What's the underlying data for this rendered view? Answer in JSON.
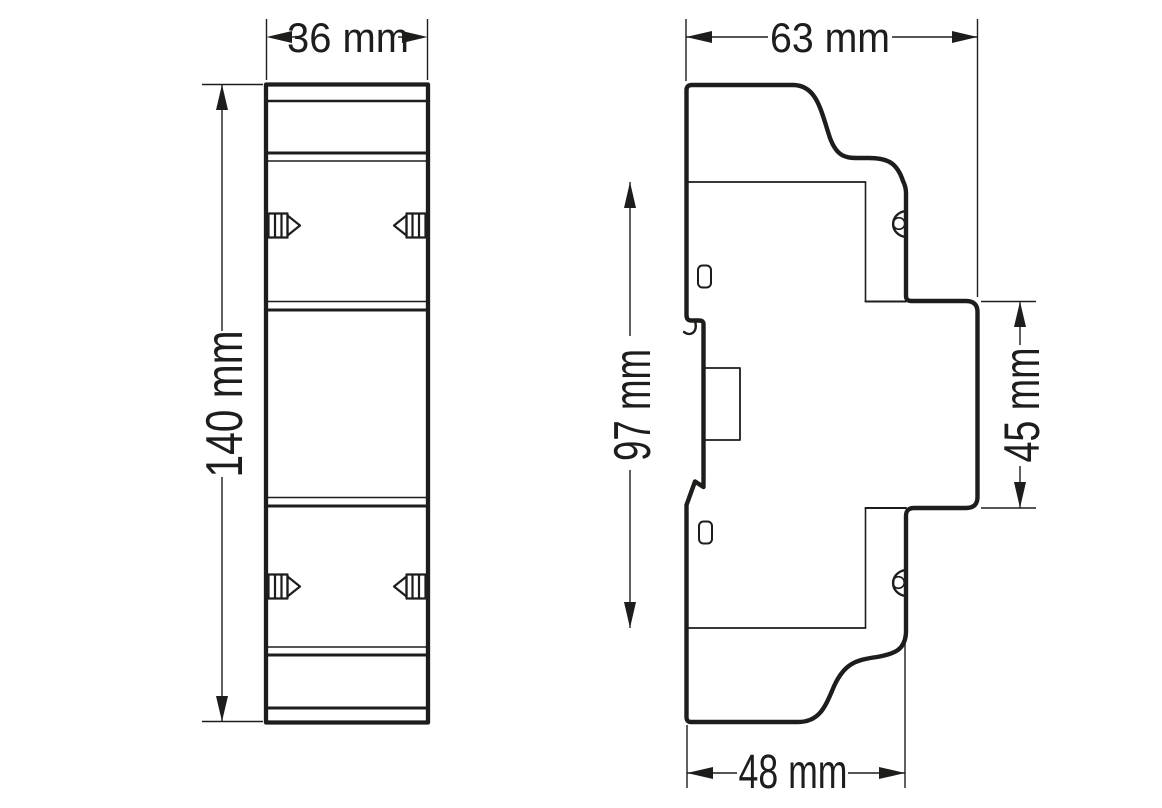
{
  "page": {
    "background": "#ffffff",
    "line_color": "#1d1d1b"
  },
  "drawing": {
    "dims": {
      "w36": {
        "label": "36 mm",
        "value": 36,
        "unit": "mm",
        "orientation": "horizontal"
      },
      "h140": {
        "label": "140 mm",
        "value": 140,
        "unit": "mm",
        "orientation": "vertical"
      },
      "d63": {
        "label": "63 mm",
        "value": 63,
        "unit": "mm",
        "orientation": "horizontal"
      },
      "h97": {
        "label": "97 mm",
        "value": 97,
        "unit": "mm",
        "orientation": "vertical"
      },
      "h45": {
        "label": "45 mm",
        "value": 45,
        "unit": "mm",
        "orientation": "vertical"
      },
      "d48": {
        "label": "48 mm",
        "value": 48,
        "unit": "mm",
        "orientation": "horizontal"
      }
    }
  }
}
